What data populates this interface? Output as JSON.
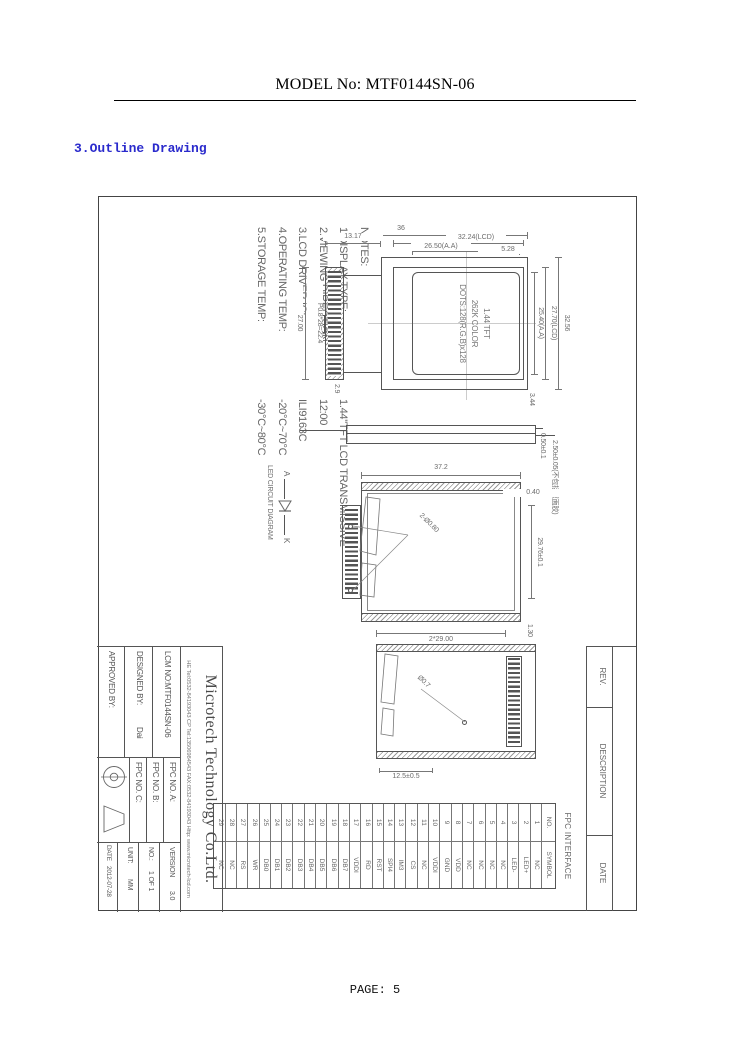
{
  "page": {
    "model_label": "MODEL No: MTF0144SN-06",
    "section_title": "3.Outline Drawing",
    "page_footer": "PAGE: 5"
  },
  "notes": {
    "title": "NOTES:",
    "items": [
      {
        "label": "1.DISPLAY TYPE:",
        "value": "1.44\"TFT LCD TRANSMISSIVE"
      },
      {
        "label": "2.VIEWING DIRECTION:",
        "value": "12:00"
      },
      {
        "label": "3.LCD DRIVER IC:",
        "value": "ILI9163C"
      },
      {
        "label": "4.OPERATING TEMP:",
        "value": "-20°C~70°C"
      },
      {
        "label": "5.STORAGE TEMP:",
        "value": "-30°C~80°C"
      }
    ]
  },
  "front_view": {
    "screen_lines": [
      "1.44 TFT",
      "262K COLOR",
      "DOTS:128(R.G.B)x128"
    ],
    "dims": {
      "module_w": "32.56",
      "lcd_w": "27.70(LCD)",
      "aa_w": "25.40(A.A)",
      "module_h": "36",
      "lcd_h": "32.24(LCD)",
      "aa_h": "26.50(A.A)",
      "tail_len": "13.17",
      "edge_top": "3.44",
      "edge_side": "5.28",
      "conn_h": "2.9",
      "pin_pitch": "P0.8*28=22.4",
      "conn_w": "27.00"
    }
  },
  "side_view": {
    "dims": {
      "lcd_thickness": "0.50±0.1",
      "total_thickness": "2.50±0.05(不包括双面胶)"
    }
  },
  "back_view": {
    "dims": {
      "height": "37.2",
      "gap": "0.40",
      "holes": "2-Ø0.80",
      "fpc_width": "29.76±0.1",
      "pad_span": "2*29.00",
      "tape_edge": "1.30"
    },
    "led": {
      "anode": "A",
      "cathode": "K",
      "label": "LED CIRCUIT DIAGRAM"
    }
  },
  "folded_view": {
    "dims": {
      "fold_width": "12.5±0.5",
      "hole": "Ø0.7"
    }
  },
  "fpc_table": {
    "title": "FPC INTERFACE",
    "headers": [
      "NO.",
      "SYMBOL"
    ],
    "rows": [
      [
        "1",
        "NC"
      ],
      [
        "2",
        "LED+"
      ],
      [
        "3",
        "LED-"
      ],
      [
        "4",
        "NC"
      ],
      [
        "5",
        "NC"
      ],
      [
        "6",
        "NC"
      ],
      [
        "7",
        "NC"
      ],
      [
        "8",
        "VDD"
      ],
      [
        "9",
        "GND"
      ],
      [
        "10",
        "VDDI"
      ],
      [
        "11",
        "NC"
      ],
      [
        "12",
        "CS"
      ],
      [
        "13",
        "IM3"
      ],
      [
        "14",
        "SPI4"
      ],
      [
        "15",
        "RST"
      ],
      [
        "16",
        "RD"
      ],
      [
        "17",
        "VDDI"
      ],
      [
        "18",
        "DB7"
      ],
      [
        "19",
        "DB6"
      ],
      [
        "20",
        "DB5"
      ],
      [
        "21",
        "DB4"
      ],
      [
        "22",
        "DB3"
      ],
      [
        "23",
        "DB2"
      ],
      [
        "24",
        "DB1"
      ],
      [
        "25",
        "DB0"
      ],
      [
        "26",
        "WR"
      ],
      [
        "27",
        "RS"
      ],
      [
        "28",
        "NC"
      ],
      [
        "29",
        "NC"
      ]
    ]
  },
  "title_block": {
    "company": "Microtech Technology Co.Ltd.",
    "contact": "HE Tel:0532-84193043  CP Tel:13506984543  FAX:0532-84193043  Http: www.microtech-lcd.com",
    "lcm_no": "LCM NO:MTF0144SN-06",
    "designed_by": "DESIGNED BY:",
    "designer": "Dai",
    "approved_by": "APPROVED BY:",
    "fpc_a": "FPC NO. A:",
    "fpc_b": "FPC NO. B:",
    "fpc_c": "FPC NO. C:",
    "version_label": "VERSION",
    "version": "3.0",
    "no_label": "NO.:",
    "no_value": "1 OF 1",
    "unit_label": "UNIT:",
    "unit": "MM",
    "date_label": "DATE",
    "date": "2012-07-28"
  },
  "rev_strip": {
    "headers": [
      "REV.",
      "DESCRIPTION",
      "DATE"
    ]
  }
}
